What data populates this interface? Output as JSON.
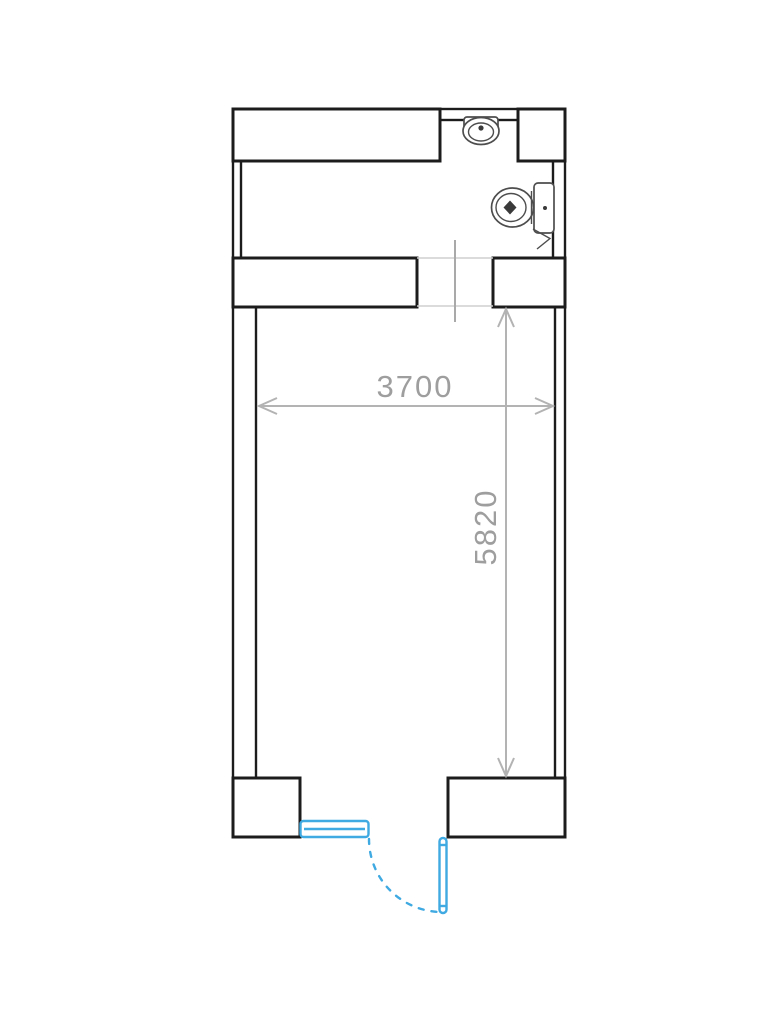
{
  "plan": {
    "type": "floor-plan",
    "dimensions": {
      "width": {
        "label": "3700"
      },
      "height": {
        "label": "5820"
      }
    },
    "fixtures": [
      {
        "name": "sink"
      },
      {
        "name": "toilet"
      }
    ],
    "doors": [
      {
        "name": "entry-swing-door",
        "style": "hinged swing with dashed arc"
      },
      {
        "name": "side-sliding-panel",
        "style": "double-line sliding panel"
      }
    ],
    "colors": {
      "wall_outline": "#1c1c1c",
      "fixture_outline": "#4d4d4d",
      "door_accent": "#3fa9e1",
      "dimension_line": "#b3b3b3",
      "dimension_text": "#9e9e9e",
      "background": "#ffffff"
    }
  }
}
